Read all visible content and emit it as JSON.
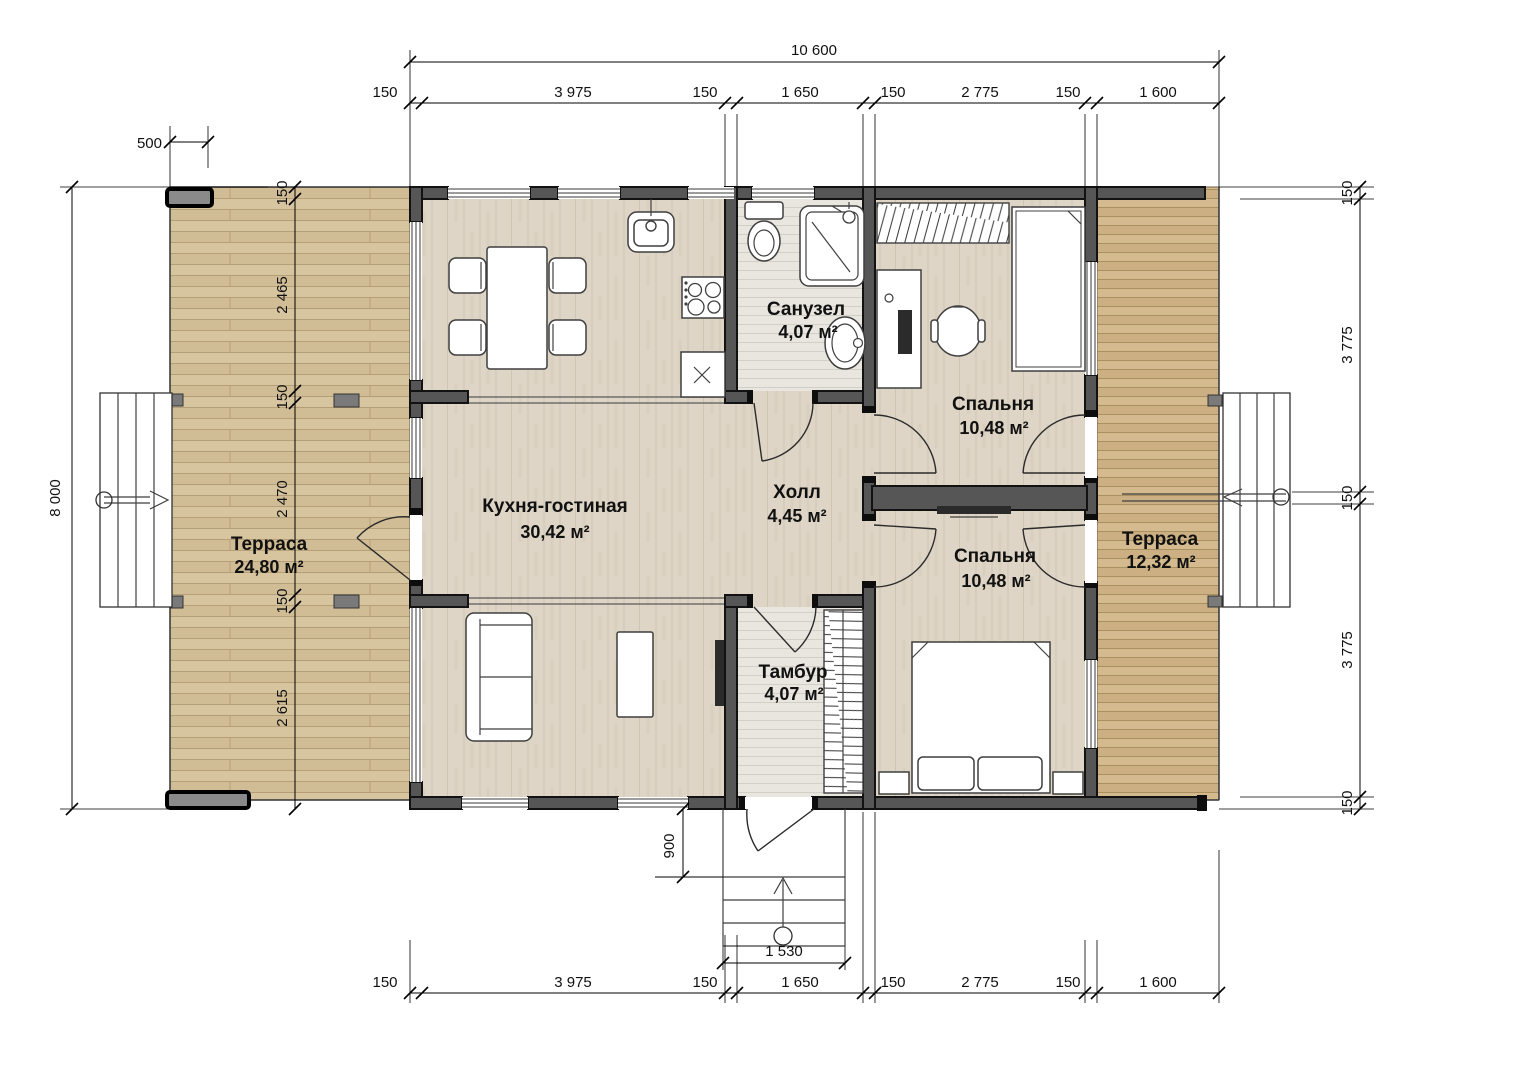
{
  "drawing": {
    "rooms": {
      "terrace_left": {
        "name": "Терраса",
        "area": "24,80 м²"
      },
      "kitchen_living": {
        "name": "Кухня-гостиная",
        "area": "30,42 м²"
      },
      "bathroom": {
        "name": "Санузел",
        "area": "4,07 м²"
      },
      "hall": {
        "name": "Холл",
        "area": "4,45 м²"
      },
      "bedroom_top": {
        "name": "Спальня",
        "area": "10,48 м²"
      },
      "bedroom_bottom": {
        "name": "Спальня",
        "area": "10,48 м²"
      },
      "vestibule": {
        "name": "Тамбур",
        "area": "4,07 м²"
      },
      "terrace_right": {
        "name": "Терраса",
        "area": "12,32 м²"
      }
    },
    "dimensions": {
      "top_total": "10 600",
      "top_chain": [
        "150",
        "3 975",
        "150",
        "1 650",
        "150",
        "2 775",
        "150",
        "1 600"
      ],
      "bottom_chain": [
        "150",
        "3 975",
        "150",
        "1 650",
        "150",
        "2 775",
        "150",
        "1 600"
      ],
      "left_total": "8 000",
      "left_offset": "500",
      "left_chain": [
        "150",
        "2 465",
        "150",
        "2 470",
        "150",
        "2 615"
      ],
      "right_chain": [
        "150",
        "3 775",
        "150",
        "3 775",
        "150"
      ],
      "porch_depth": "900",
      "porch_width": "1 530"
    },
    "colors": {
      "wall": "#565656",
      "terrace_wood": "#d7c5a0",
      "interior_floor": "#ded5c6",
      "tile_floor": "#e9e6e0"
    }
  }
}
